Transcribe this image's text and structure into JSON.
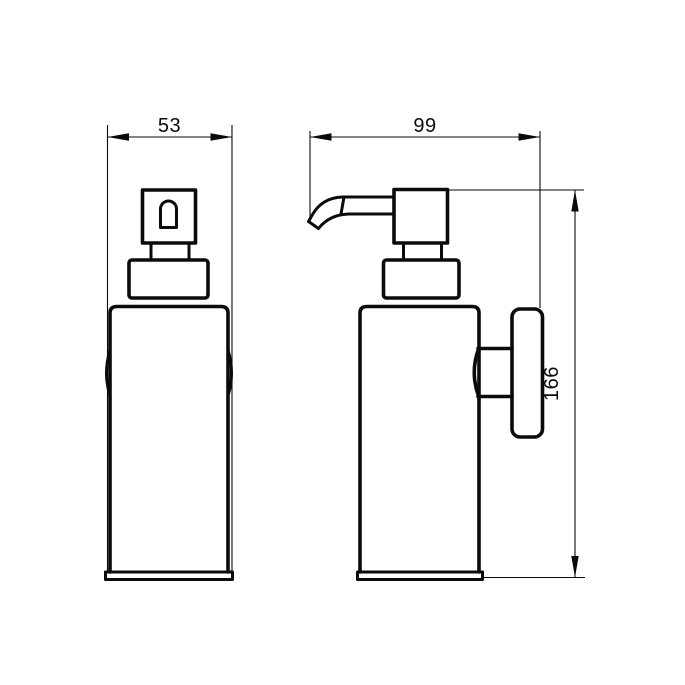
{
  "page": {
    "background": "#ffffff",
    "line_color": "#0b0b0b"
  },
  "drawing": {
    "type": "technical dimension drawing, two orthographic views of a wall-mounted soap dispenser",
    "dimensions": {
      "front_width": "53",
      "side_depth": "99",
      "height": "166"
    }
  }
}
